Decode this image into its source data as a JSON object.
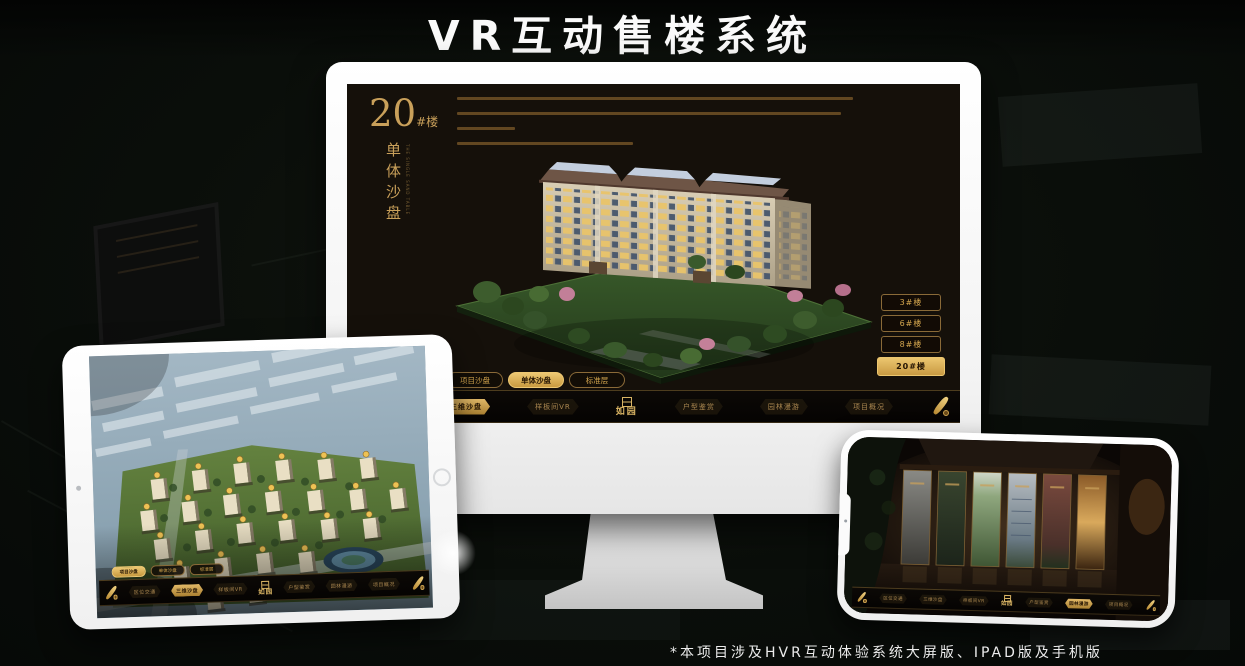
{
  "page": {
    "title": "VR互动售楼系统",
    "footnote": "*本项目涉及HVR互动体验系统大屏版、IPAD版及手机版"
  },
  "colors": {
    "gold": "#c9a05a",
    "gold_bright": "#e3bc6a",
    "gold_active_bg": "#d9b05c",
    "active_text": "#241403",
    "screen_bg": "#15100a",
    "page_bg": "#0a0e0b",
    "device_white": "#ffffff"
  },
  "app": {
    "logo": "如园",
    "nav_items": [
      {
        "label": "区位交通"
      },
      {
        "label": "三维沙盘"
      },
      {
        "label": "样板间VR"
      },
      {
        "label": "户型鉴赏"
      },
      {
        "label": "园林漫游"
      },
      {
        "label": "项目概况"
      }
    ],
    "view_tabs": [
      {
        "label": "项目沙盘"
      },
      {
        "label": "单体沙盘"
      },
      {
        "label": "标准层"
      }
    ]
  },
  "monitor": {
    "title_number": "20",
    "title_suffix": "#楼",
    "title_vertical": "单体沙盘",
    "title_en": "THE SINGLE SAND TABLE",
    "active_tab": "单体沙盘",
    "active_nav": "三维沙盘",
    "floor_buttons": [
      {
        "label": "3#楼"
      },
      {
        "label": "6#楼"
      },
      {
        "label": "8#楼"
      },
      {
        "label": "20#楼"
      }
    ]
  },
  "tablet": {
    "active_tab": "项目沙盘",
    "active_nav": "三维沙盘"
  },
  "phone": {
    "active_nav": "园林漫游"
  }
}
